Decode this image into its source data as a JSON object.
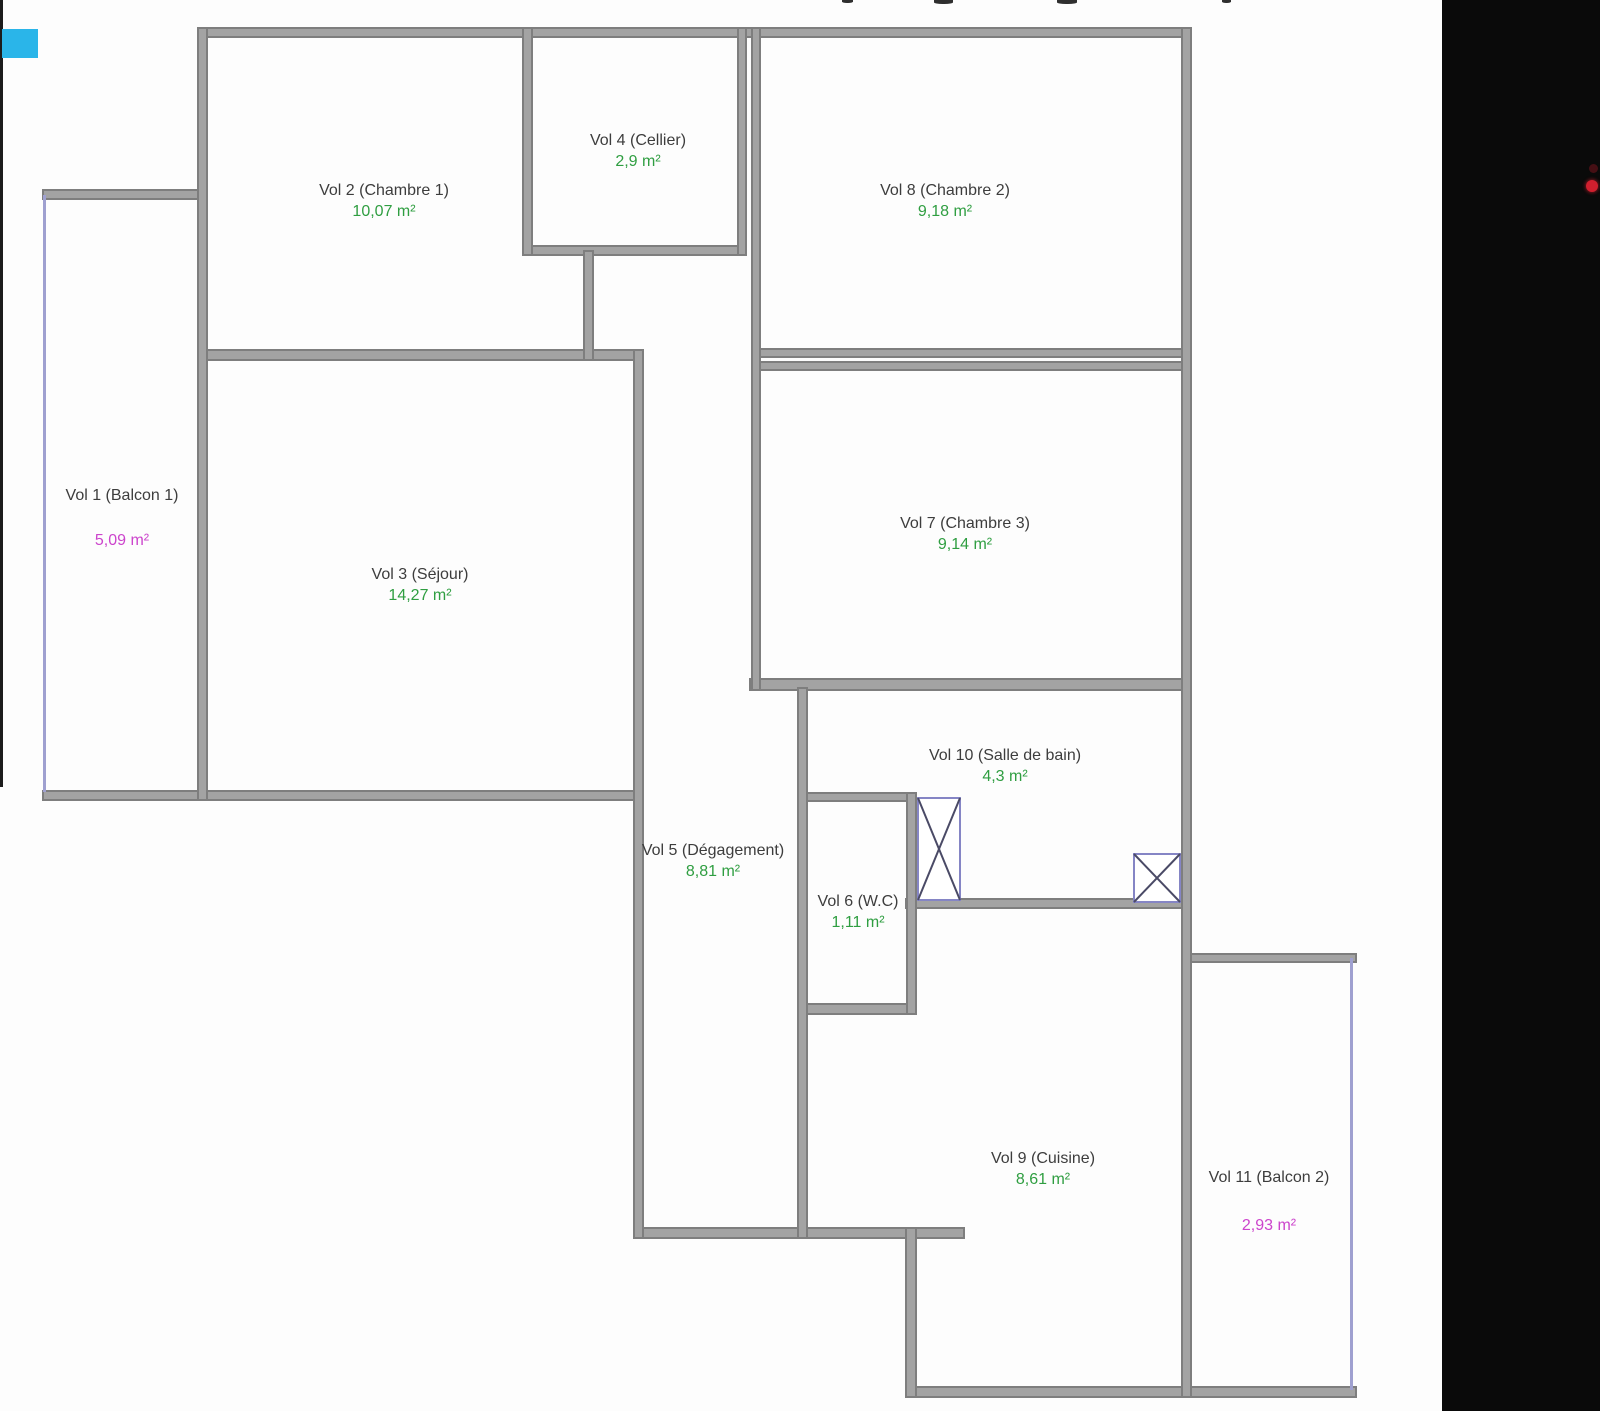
{
  "plan": {
    "type": "floor-plan",
    "language": "fr",
    "rooms": [
      {
        "id": "vol-1",
        "name": "Vol 1 (Balcon 1)",
        "area": "5,09 m²",
        "accent": "magenta"
      },
      {
        "id": "vol-2",
        "name": "Vol 2 (Chambre 1)",
        "area": "10,07 m²",
        "accent": "green"
      },
      {
        "id": "vol-3",
        "name": "Vol 3 (Séjour)",
        "area": "14,27 m²",
        "accent": "green"
      },
      {
        "id": "vol-4",
        "name": "Vol 4 (Cellier)",
        "area": "2,9 m²",
        "accent": "green"
      },
      {
        "id": "vol-5",
        "name": "Vol 5 (Dégagement)",
        "area": "8,81 m²",
        "accent": "green"
      },
      {
        "id": "vol-6",
        "name": "Vol 6 (W.C)",
        "area": "1,11 m²",
        "accent": "green"
      },
      {
        "id": "vol-7",
        "name": "Vol 7 (Chambre 3)",
        "area": "9,14 m²",
        "accent": "green"
      },
      {
        "id": "vol-8",
        "name": "Vol 8 (Chambre 2)",
        "area": "9,18 m²",
        "accent": "green"
      },
      {
        "id": "vol-9",
        "name": "Vol 9 (Cuisine)",
        "area": "8,61 m²",
        "accent": "green"
      },
      {
        "id": "vol-10",
        "name": "Vol 10 (Salle de bain)",
        "area": "4,3 m²",
        "accent": "green"
      },
      {
        "id": "vol-11",
        "name": "Vol 11 (Balcon 2)",
        "area": "2,93 m²",
        "accent": "magenta"
      }
    ]
  },
  "colors": {
    "area_green": "#2f9e41",
    "area_magenta": "#cc44cc",
    "label_text": "#3d3d3d",
    "wall_fill": "#a3a3a3",
    "wall_edge": "#7e7e7e",
    "balcony_line": "#9fa0d0",
    "fixture_box": "#8585c5",
    "fixture_cross": "#4a4a66",
    "highlight_cyan": "#2ab5e9",
    "indicator_red": "#d01f2e",
    "screen_black": "#0a0a0a",
    "background": "#fdfdfd"
  }
}
